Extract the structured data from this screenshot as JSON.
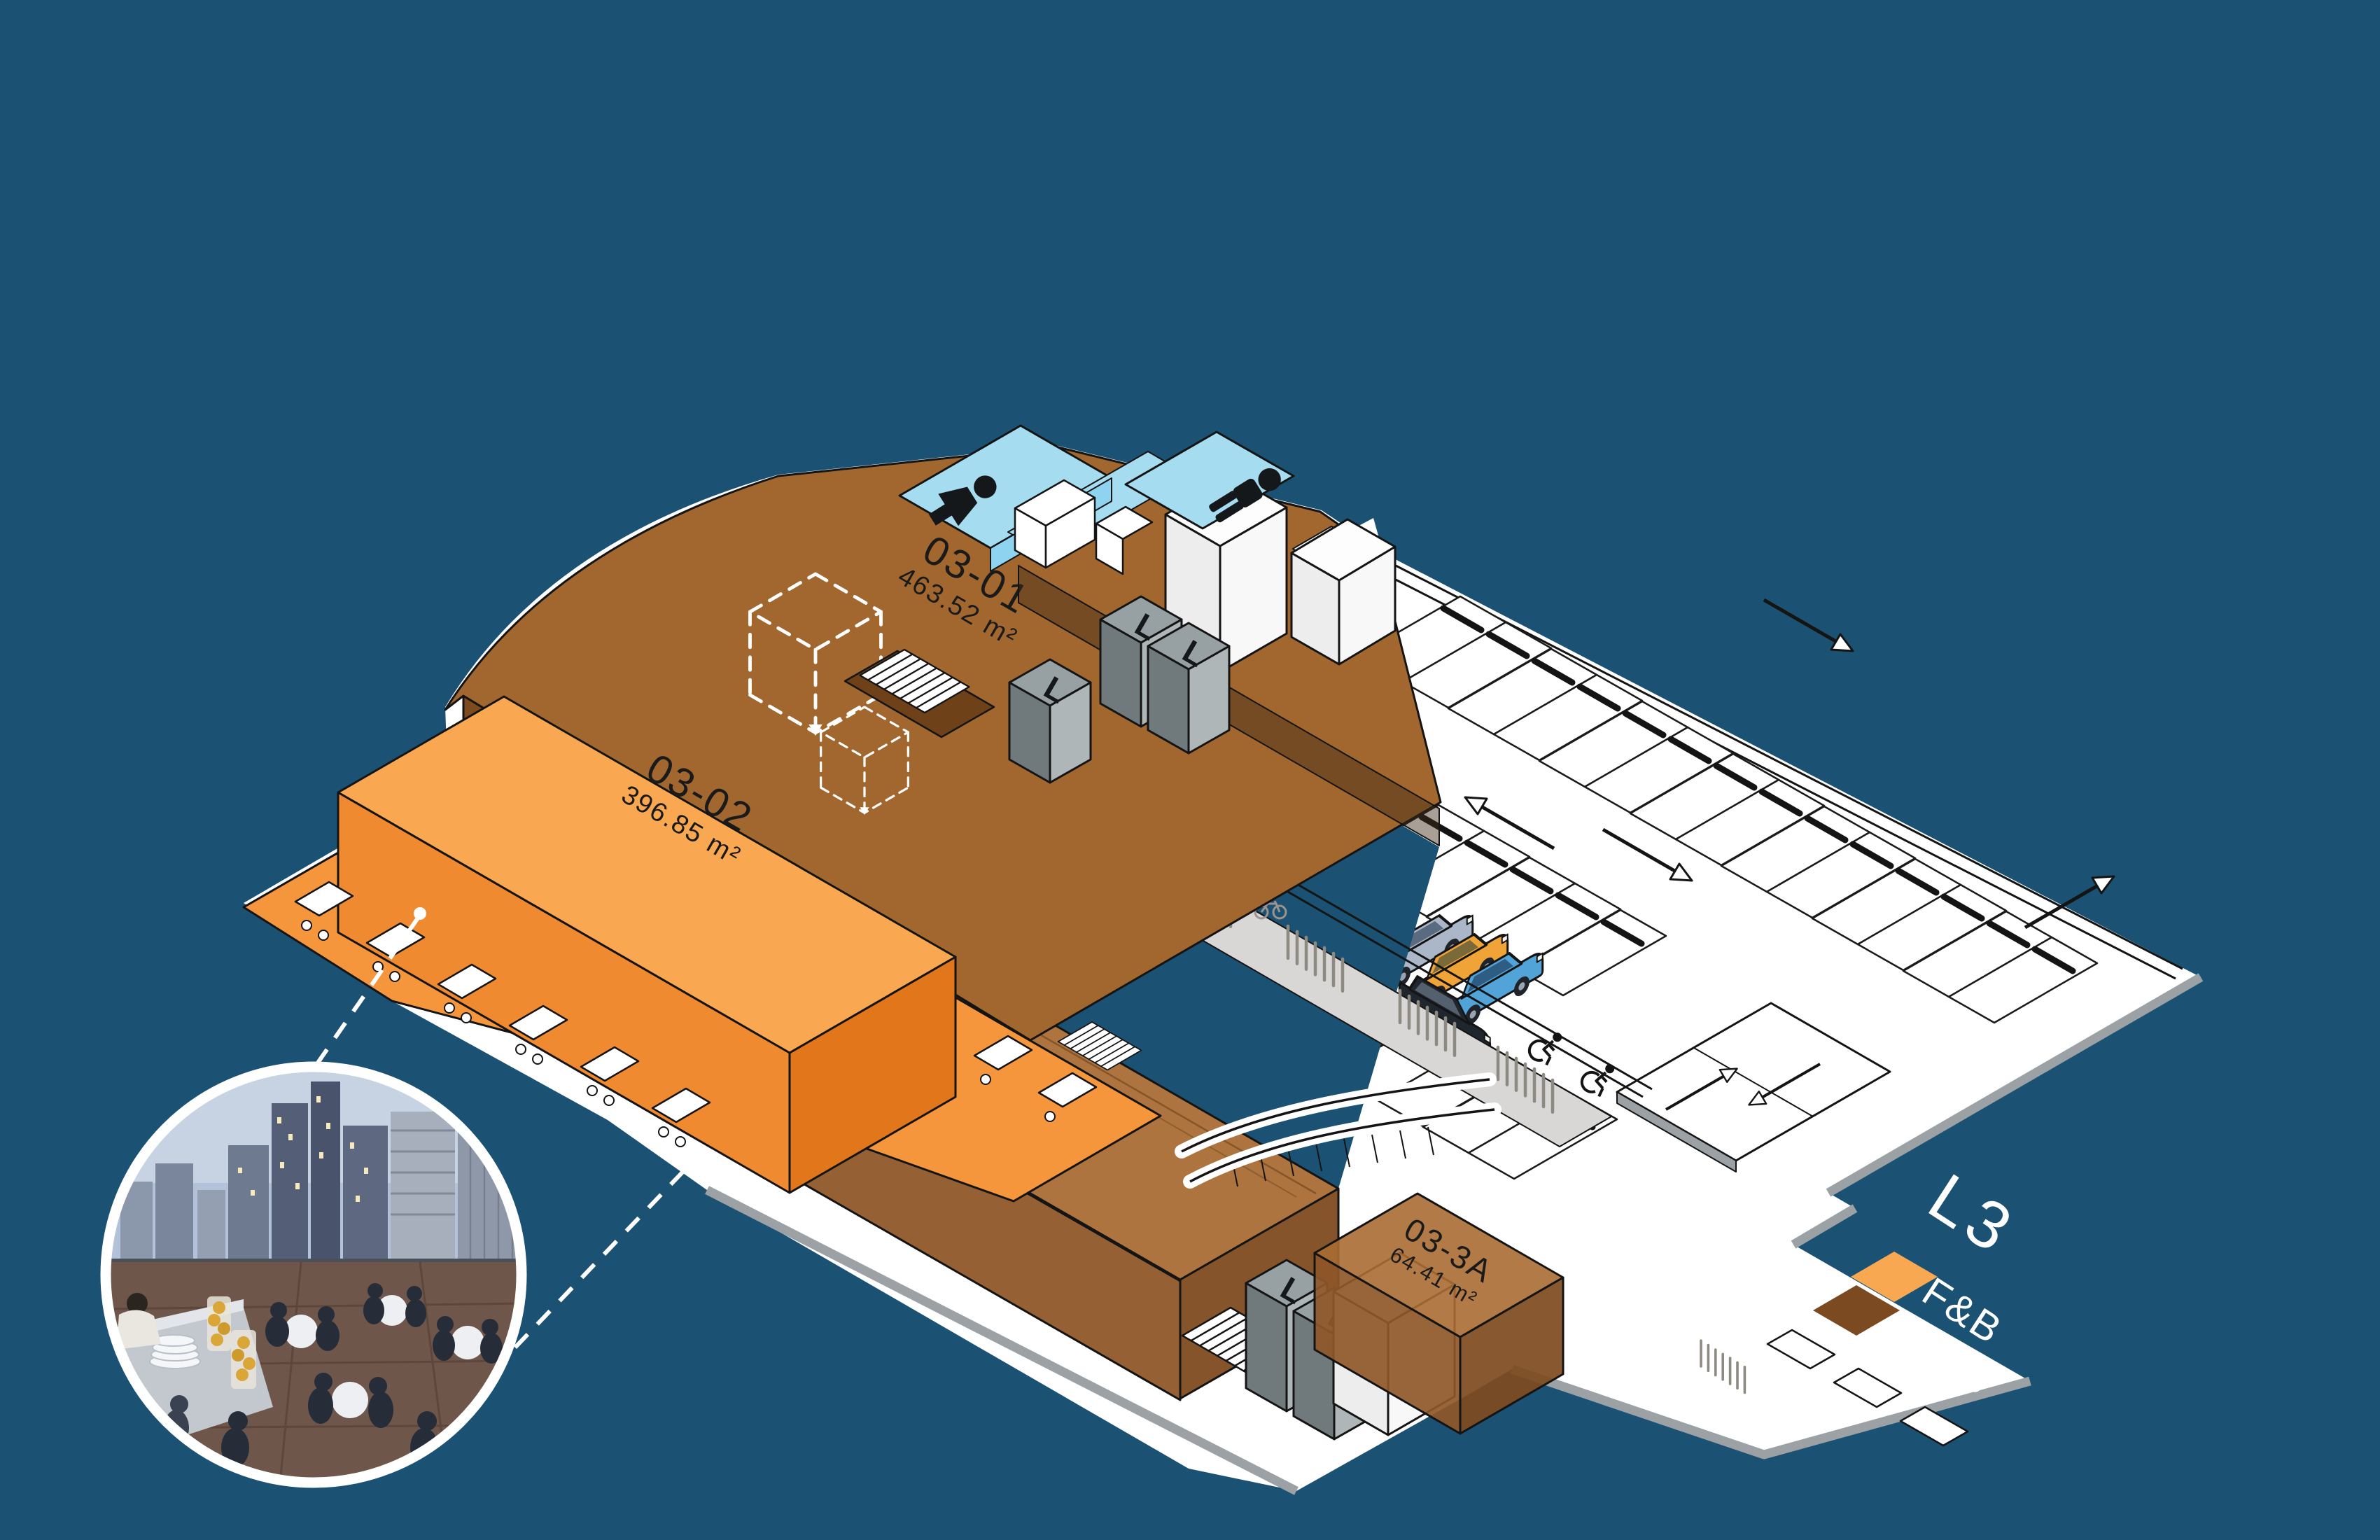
{
  "page": {
    "background": "#1B5173"
  },
  "floor_plan": {
    "level_label": "L3",
    "legend": [
      {
        "label": "F&B",
        "color": "#F8A851"
      },
      {
        "label": "Office",
        "color": "#7B4A21"
      }
    ],
    "units": [
      {
        "id": "03-01",
        "area": "463.52 m²",
        "category": "Office"
      },
      {
        "id": "03-02",
        "area": "396.85 m²",
        "category": "F&B"
      },
      {
        "id": "03-03",
        "area": "356.66 m²",
        "category": "Office"
      },
      {
        "id": "03-3A",
        "area": "64.41 m²",
        "category": "Office"
      }
    ],
    "lift_label": "L",
    "icons": [
      "female-restroom-icon",
      "male-restroom-icon",
      "wheelchair-icon",
      "bicycle-icon",
      "direction-arrow-icon"
    ],
    "colors": {
      "office_floor": "#A2672F",
      "office_side": "#7E4B1F",
      "office_block_top": "#A86B33",
      "office_block_front": "#8F5728",
      "office_block_side": "#7E4B1F",
      "fnb_floor": "#F5953C",
      "fnb_block_top": "#F9A851",
      "fnb_block_front": "#F08A31",
      "fnb_block_side": "#E2761A",
      "restroom_floor": "#A5DCF0",
      "restroom_wall": "#8ED3F0",
      "lift_top": "#97A1A3",
      "lift_left": "#707A7C",
      "lift_right": "#AEB6B8",
      "plinth": "#FFFFFF",
      "curb": "#9BA1A5",
      "apron": "#D8D7D5",
      "outline": "#141414"
    },
    "cars": [
      {
        "name": "red-car",
        "color": "#C5303A"
      },
      {
        "name": "teal-car",
        "color": "#4FBFA3"
      },
      {
        "name": "silver-car",
        "color": "#ABB7C8"
      },
      {
        "name": "yellow-car",
        "color": "#F0A437"
      },
      {
        "name": "blue-car",
        "color": "#52A3D8"
      },
      {
        "name": "black-car",
        "color": "#20262E"
      }
    ]
  },
  "photo": {
    "sky_top": "#C7D2E3",
    "sky_low": "#B3C2D8",
    "terrace_floor": "#6E564B"
  }
}
